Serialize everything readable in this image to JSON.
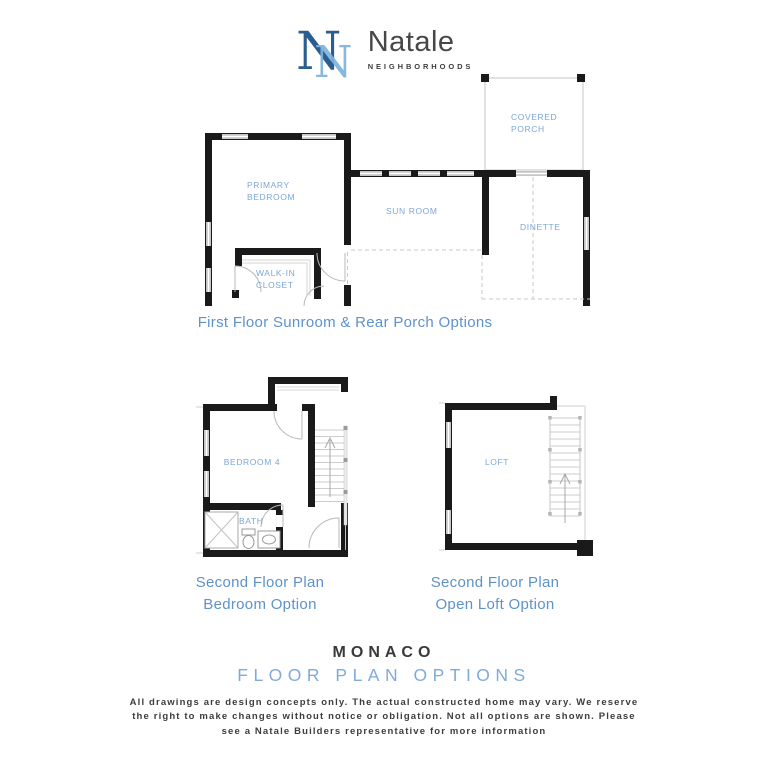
{
  "logo": {
    "monogram": "N",
    "brand": "Natale",
    "tagline": "NEIGHBORHOODS"
  },
  "first_floor": {
    "caption": "First Floor Sunroom & Rear Porch Options",
    "rooms": {
      "primary_bedroom": "PRIMARY BEDROOM",
      "sun_room": "SUN ROOM",
      "covered_porch": "COVERED PORCH",
      "dinette": "DINETTE",
      "walk_in_closet": "WALK-IN CLOSET"
    }
  },
  "second_floor_bedroom": {
    "caption_line1": "Second Floor Plan",
    "caption_line2": "Bedroom Option",
    "rooms": {
      "bedroom_4": "BEDROOM 4",
      "bath": "BATH"
    }
  },
  "second_floor_loft": {
    "caption_line1": "Second Floor Plan",
    "caption_line2": "Open Loft Option",
    "rooms": {
      "loft": "LOFT"
    }
  },
  "footer": {
    "plan_name": "MONACO",
    "subtitle": "FLOOR PLAN OPTIONS",
    "disclaimer_lines": [
      "All drawings are design concepts only. The actual constructed home may vary. We reserve",
      "the right to make changes without notice or obligation. Not all options are shown. Please",
      "see a Natale Builders representative for more information"
    ]
  },
  "colors": {
    "room_label_blue": "#7BA6D8",
    "caption_blue": "#5E92CB",
    "subtitle_blue": "#7FABDC",
    "heading_dark": "#393939",
    "wall_black": "#1A1A1A",
    "logo_dark_blue": "#2B5D8F",
    "logo_light_blue": "#7FB2DC"
  }
}
